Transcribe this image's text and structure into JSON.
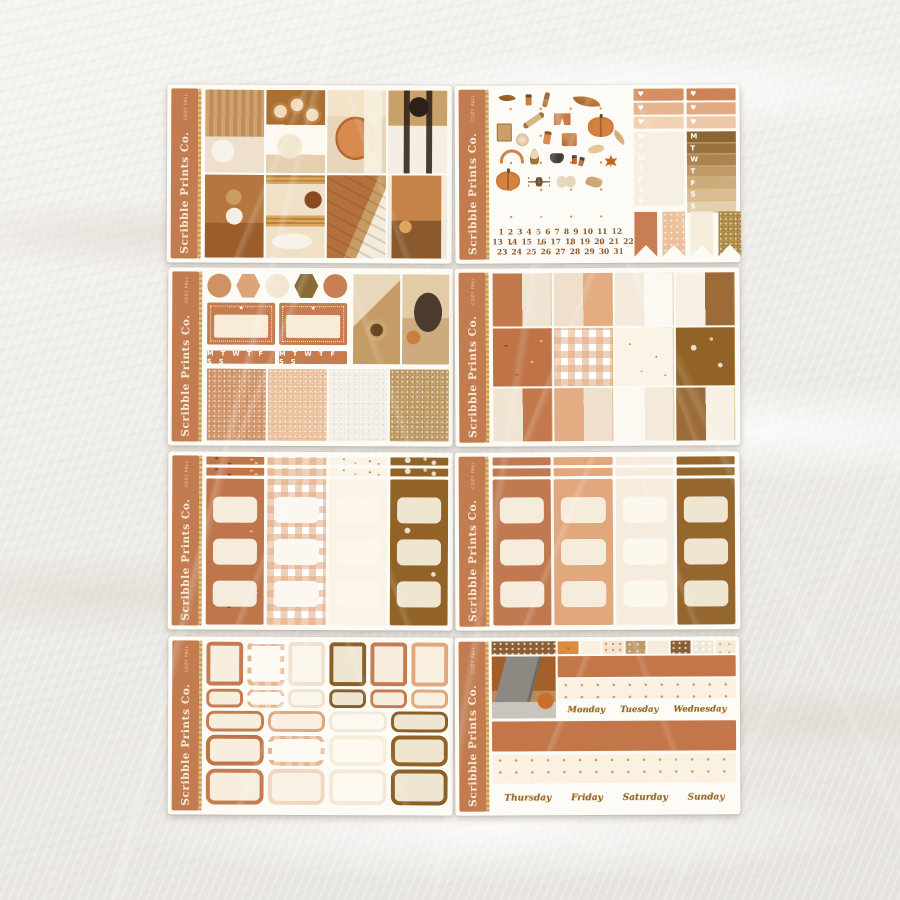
{
  "brand": {
    "name": "Scribble Prints Co.",
    "kit_label": "COZY FALL"
  },
  "palette": {
    "sheet": "#fdfbf6",
    "spine": "#c27c50",
    "terracotta": "#c57c50",
    "peach": "#e2a87e",
    "peach_light": "#eec7a6",
    "cream": "#f3e8d6",
    "warm_white": "#fbf8f1",
    "brown": "#95672f",
    "olive_gold": "#8a6a33",
    "tan": "#d9c3a4",
    "gold_glitter": "#ab853e",
    "copper_glitter": "#cf9265"
  },
  "sheets": [
    {
      "id": 1,
      "name": "weekly-kit-photo-full-boxes"
    },
    {
      "id": 2,
      "name": "deco-stickers-date-numbers-weekly-extras"
    },
    {
      "id": 3,
      "name": "hexagons-tickets-glitter-swatches"
    },
    {
      "id": 4,
      "name": "solid-and-patterned-full-box-patchwork"
    },
    {
      "id": 5,
      "name": "patterned-half-box-columns"
    },
    {
      "id": 6,
      "name": "solid-half-box-columns"
    },
    {
      "id": 7,
      "name": "label-and-quarter-box-stickers"
    },
    {
      "id": 8,
      "name": "photo-washi-and-day-script-stickers"
    }
  ],
  "sheet2": {
    "calendar_rows": [
      "1 2 3 4 5 6 7 8 9 10 11 12",
      "13 14 15 16 17 18 19 20 21 22",
      "23 24 25 26 27 28 29 30 31"
    ],
    "weekday_letters": [
      "M",
      "T",
      "W",
      "T",
      "F",
      "S",
      "S"
    ],
    "deco_sticker_names": [
      "brown-leaf",
      "lotion-bottle",
      "hair-brush",
      "big-autumn-leaf",
      "rolling-pin",
      "pajama-shorts",
      "large-pumpkin",
      "face-mask-packet",
      "loofah",
      "lotion-tube",
      "pajama-top",
      "sleep-mask",
      "headband",
      "hand-mirror",
      "kettle",
      "nail-polish",
      "maple-leaf",
      "small-pumpkin",
      "glasses",
      "slippers",
      "oak-leaf"
    ]
  },
  "sheet3": {
    "weekday_strip": "M T W T F S S"
  },
  "sheet8": {
    "day_rows": [
      [
        "Monday",
        "Tuesday",
        "Wednesday"
      ],
      [
        "Thursday",
        "Friday",
        "Saturday",
        "Sunday"
      ]
    ]
  }
}
